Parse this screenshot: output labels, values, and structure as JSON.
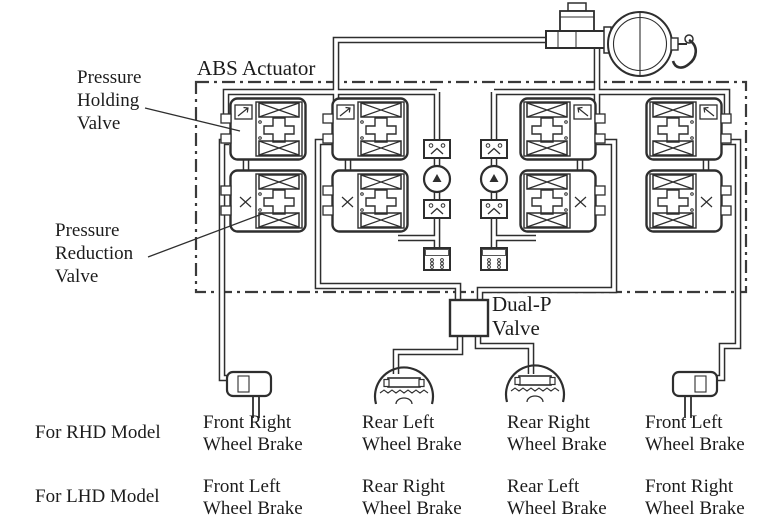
{
  "diagram": {
    "actuator_label": "ABS Actuator",
    "pressure_holding_valve": {
      "l1": "Pressure",
      "l2": "Holding",
      "l3": "Valve"
    },
    "pressure_reduction_valve": {
      "l1": "Pressure",
      "l2": "Reduction",
      "l3": "Valve"
    },
    "dual_p_valve": {
      "l1": "Dual-P",
      "l2": "Valve"
    }
  },
  "symbols": {
    "master_cylinder": "master-cylinder",
    "brake_booster": "brake-booster",
    "pedal_lever": "brake-pedal-lever",
    "solenoid_valve": "solenoid-valve",
    "pump": "pump",
    "check_valve": "check-valve",
    "reservoir": "reservoir",
    "disc_brake": "disc-brake-caliper",
    "drum_brake": "drum-brake"
  },
  "colors": {
    "ink": "#2e2e2e",
    "paper": "#ffffff"
  },
  "model_table": {
    "rows": [
      {
        "model": "For RHD Model",
        "brakes": [
          {
            "line1": "Front Right",
            "line2": "Wheel Brake"
          },
          {
            "line1": "Rear Left",
            "line2": "Wheel Brake"
          },
          {
            "line1": "Rear Right",
            "line2": "Wheel Brake"
          },
          {
            "line1": "Front Left",
            "line2": "Wheel Brake"
          }
        ]
      },
      {
        "model": "For LHD Model",
        "brakes": [
          {
            "line1": "Front Left",
            "line2": "Wheel Brake"
          },
          {
            "line1": "Rear Right",
            "line2": "Wheel Brake"
          },
          {
            "line1": "Rear Left",
            "line2": "Wheel Brake"
          },
          {
            "line1": "Front Right",
            "line2": "Wheel Brake"
          }
        ]
      }
    ]
  }
}
